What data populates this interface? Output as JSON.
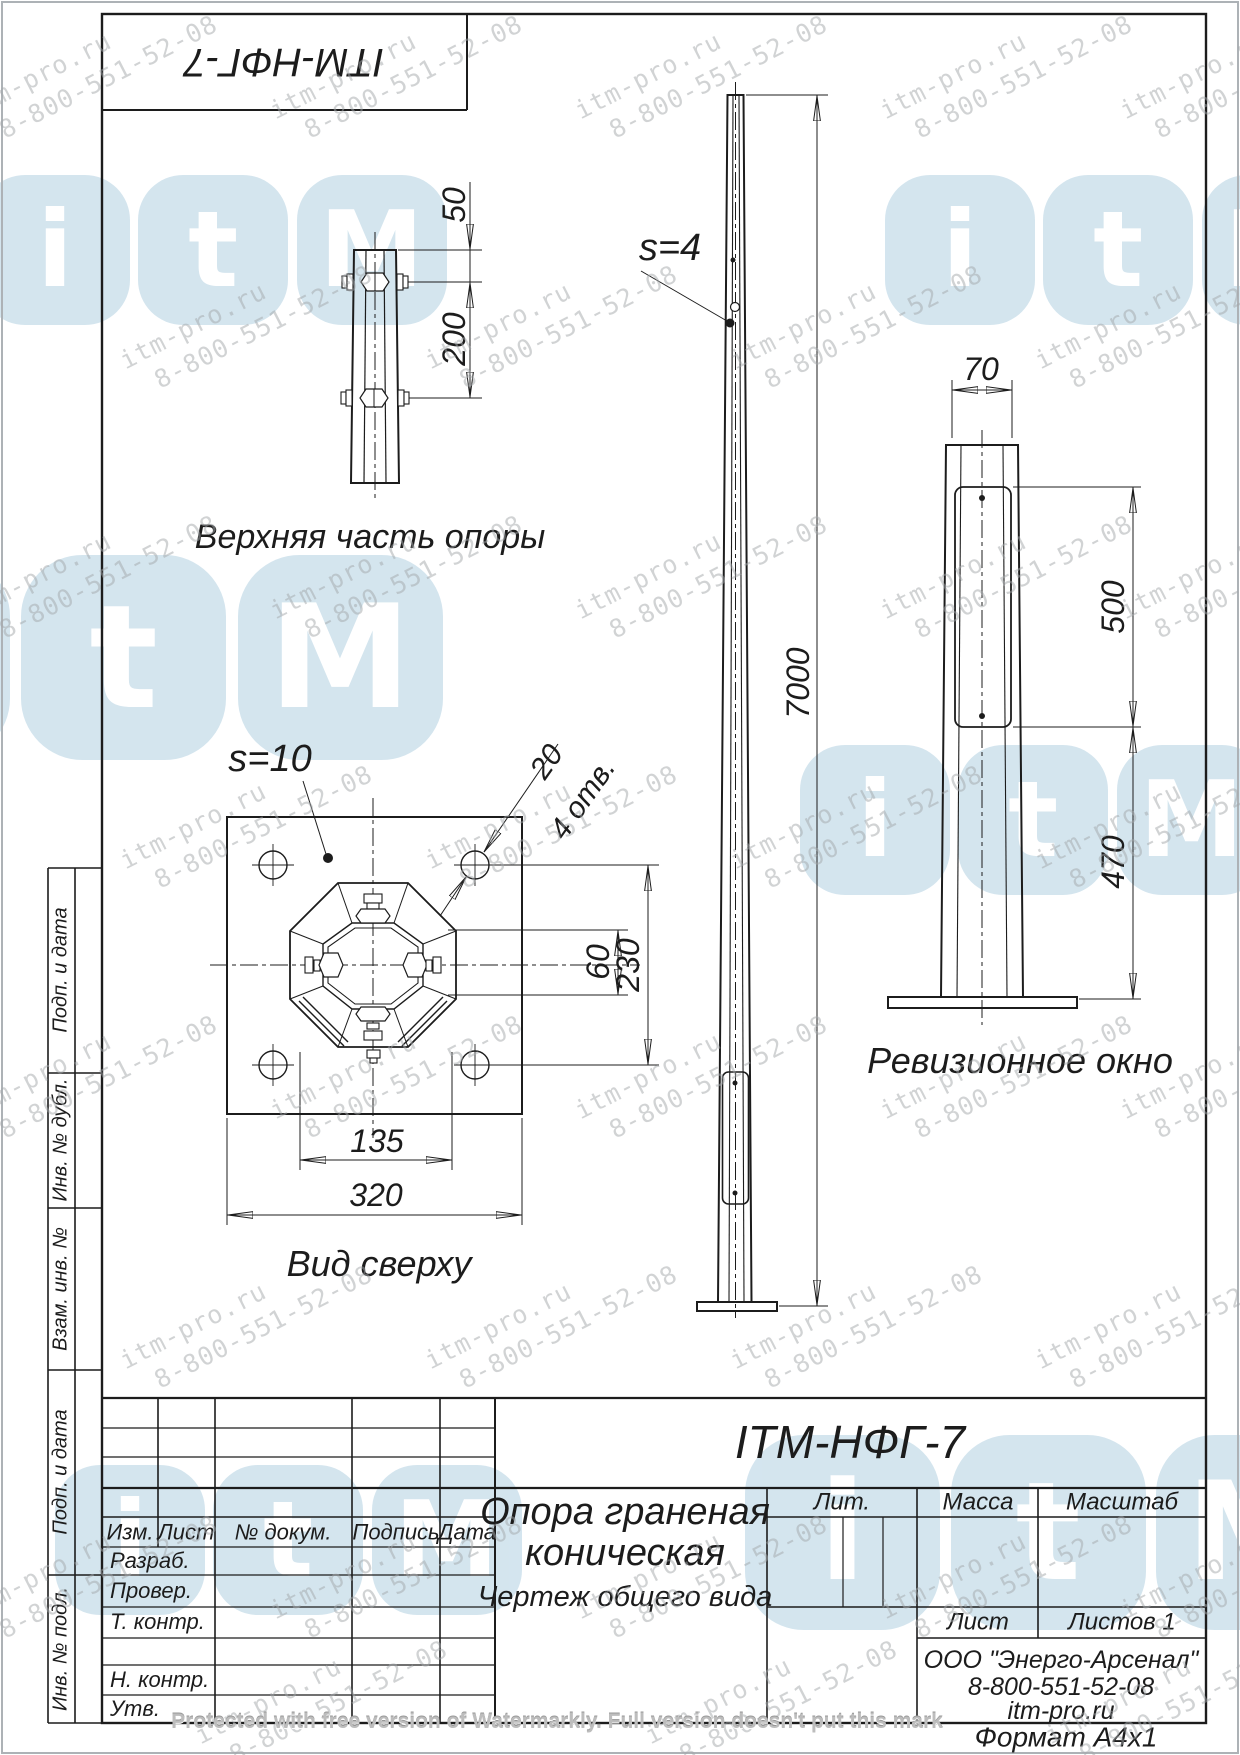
{
  "colors": {
    "line": "#1c1c1c",
    "logo_blue": "#d2e4ee",
    "watermark_gray": "#a4a8ab"
  },
  "stamp": {
    "doc_number_rotated": "ITM-НФГ-7"
  },
  "views": {
    "upper": {
      "label": "Верхняя часть опоры",
      "dim_50": "50",
      "dim_200": "200"
    },
    "front": {
      "thickness_note": "s=4",
      "dim_height": "7000"
    },
    "window": {
      "label": "Ревизионное окно",
      "dim_70": "70",
      "dim_500": "500",
      "dim_470": "470"
    },
    "top": {
      "label": "Вид сверху",
      "thickness_note": "s=10",
      "dim_hole": "20",
      "holes_note": "4 отв.",
      "dim_60": "60",
      "dim_230": "230",
      "dim_135": "135",
      "dim_320": "320"
    }
  },
  "title_block": {
    "doc_number": "ITM-НФГ-7",
    "name_line1": "Опора граненая",
    "name_line2": "коническая",
    "doc_type": "Чертеж общего вида",
    "lit": "Лит.",
    "mass": "Масса",
    "scale": "Масштаб",
    "sheet": "Лист",
    "sheets": "Листов 1",
    "org_line1": "ООО \"Энерго-Арсенал\"",
    "org_line2": "8-800-551-52-08",
    "org_line3": "itm-pro.ru",
    "format_note": "Формат  А4х1"
  },
  "revision_table": {
    "col_izm": "Изм.",
    "col_list": "Лист",
    "col_doc": "№ докум.",
    "col_sign": "Подпись",
    "col_date": "Дата",
    "row_razrab": "Разраб.",
    "row_prover": "Провер.",
    "row_tkontr": "Т. контр.",
    "row_nkontr": "Н. контр.",
    "row_utv": "Утв."
  },
  "side_labels": {
    "s1": "Подп. и дата",
    "s2": "Инв. № дубл.",
    "s3": "Взам. инв. №",
    "s4": "Подп. и дата",
    "s5": "Инв. № подл."
  },
  "watermark": {
    "line1": "itm-pro.ru",
    "line2": "8-800-551-52-08",
    "logo_letters": {
      "l1": "i",
      "l2": "t",
      "l3": "M"
    },
    "protect_note": "Protected with free version of Watermarkly. Full version doesn't put this mark",
    "tiles": [
      {
        "x": -40,
        "y": 35
      },
      {
        "x": 265,
        "y": 35
      },
      {
        "x": 570,
        "y": 35
      },
      {
        "x": 875,
        "y": 35
      },
      {
        "x": 1115,
        "y": 35
      },
      {
        "x": 115,
        "y": 285
      },
      {
        "x": 420,
        "y": 285
      },
      {
        "x": 725,
        "y": 285
      },
      {
        "x": 1030,
        "y": 285
      },
      {
        "x": -40,
        "y": 535
      },
      {
        "x": 265,
        "y": 535
      },
      {
        "x": 570,
        "y": 535
      },
      {
        "x": 875,
        "y": 535
      },
      {
        "x": 1115,
        "y": 535
      },
      {
        "x": 115,
        "y": 785
      },
      {
        "x": 420,
        "y": 785
      },
      {
        "x": 725,
        "y": 785
      },
      {
        "x": 1030,
        "y": 785
      },
      {
        "x": -40,
        "y": 1035
      },
      {
        "x": 265,
        "y": 1035
      },
      {
        "x": 570,
        "y": 1035
      },
      {
        "x": 875,
        "y": 1035
      },
      {
        "x": 1115,
        "y": 1035
      },
      {
        "x": 115,
        "y": 1285
      },
      {
        "x": 420,
        "y": 1285
      },
      {
        "x": 725,
        "y": 1285
      },
      {
        "x": 1030,
        "y": 1285
      },
      {
        "x": -40,
        "y": 1535
      },
      {
        "x": 265,
        "y": 1535
      },
      {
        "x": 570,
        "y": 1535
      },
      {
        "x": 875,
        "y": 1535
      },
      {
        "x": 1115,
        "y": 1535
      },
      {
        "x": 190,
        "y": 1660
      },
      {
        "x": 640,
        "y": 1660
      },
      {
        "x": 1040,
        "y": 1660
      }
    ],
    "logos": [
      {
        "x": -20,
        "y": 175,
        "s": 150
      },
      {
        "x": 885,
        "y": 175,
        "s": 150
      },
      {
        "x": -195,
        "y": 555,
        "s": 205
      },
      {
        "x": 800,
        "y": 745,
        "s": 150
      },
      {
        "x": 55,
        "y": 1465,
        "s": 150
      },
      {
        "x": 745,
        "y": 1435,
        "s": 195
      }
    ]
  }
}
